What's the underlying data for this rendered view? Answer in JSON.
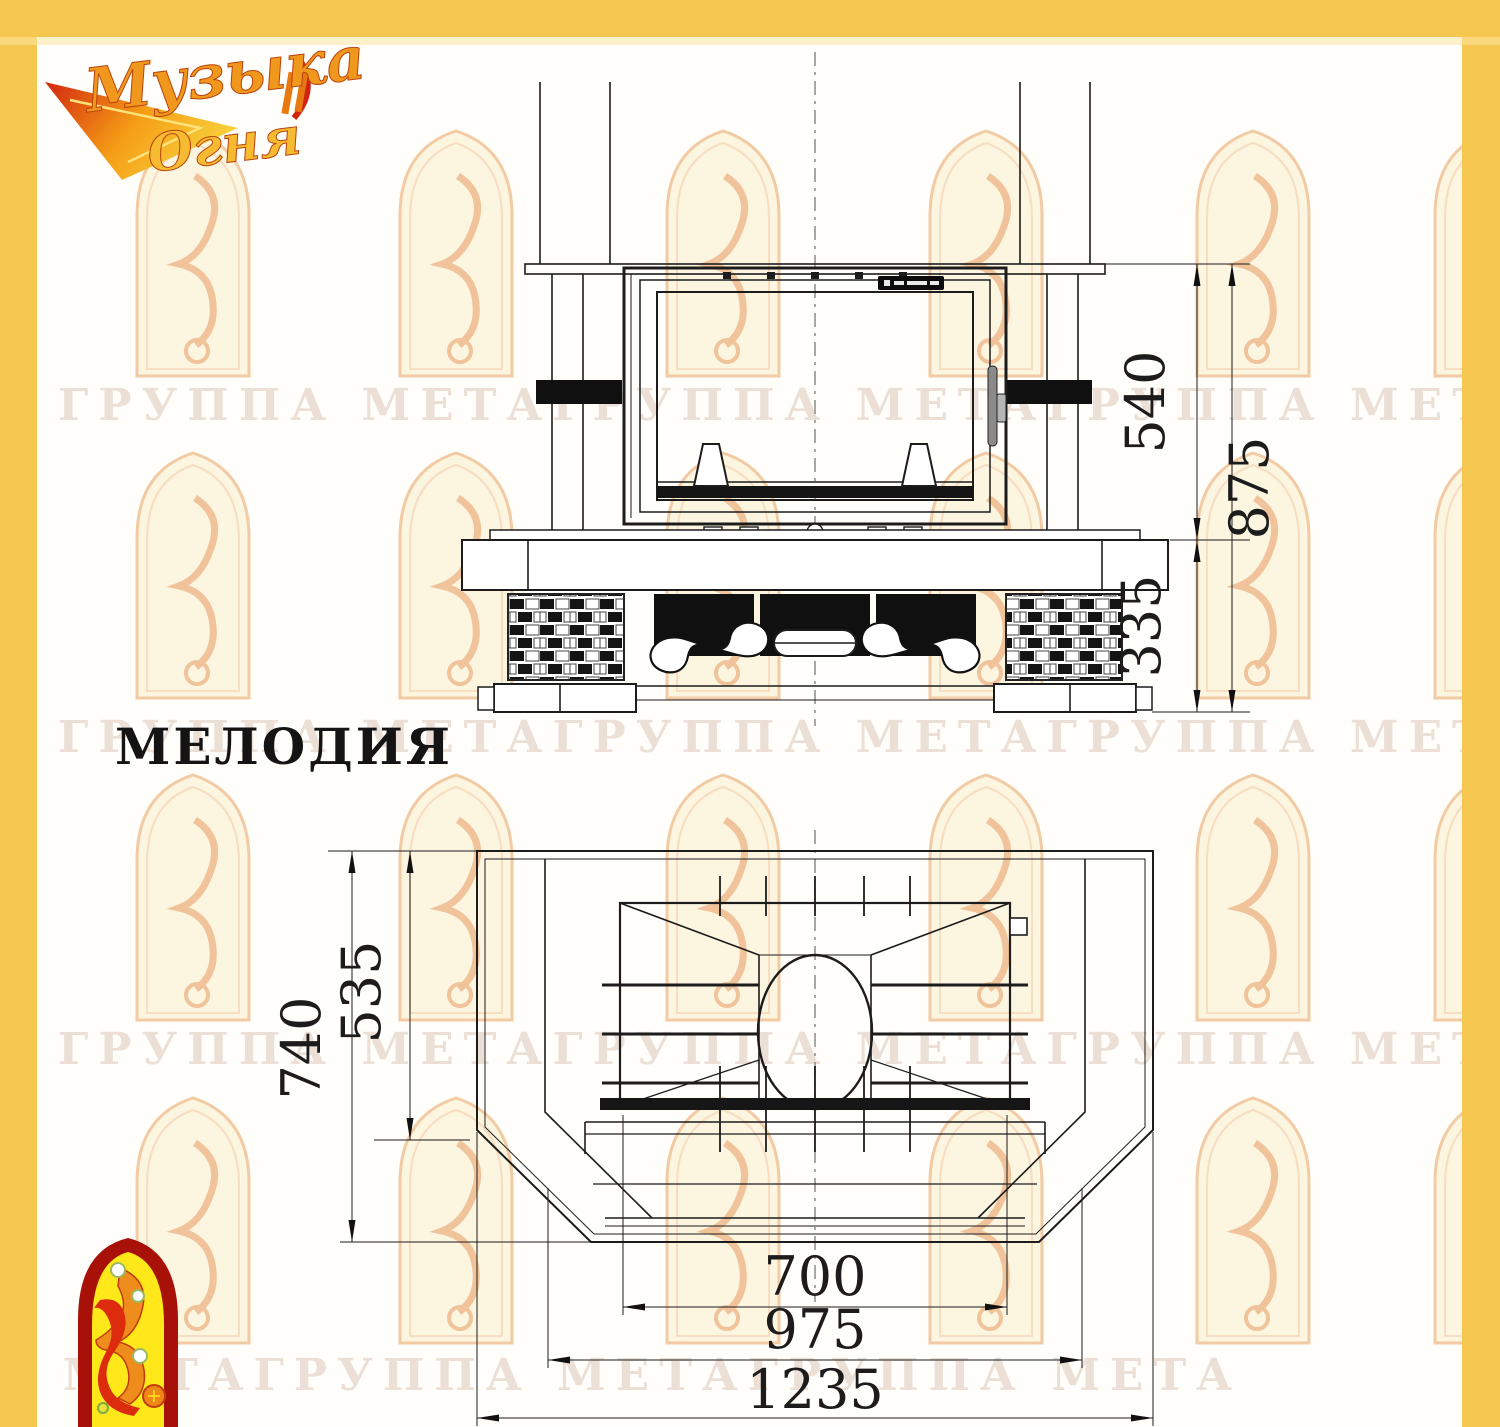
{
  "page": {
    "title": "МЕЛОДИЯ"
  },
  "brand": {
    "word1": "Музыка",
    "word2": "Огня"
  },
  "watermark": {
    "color": "#ecdfd6",
    "rows": [
      "ГРУППА МЕТАГРУППА МЕТАГРУППА МЕТА",
      "ГРУППА МЕТАГРУППА МЕТАГРУППА МЕТА",
      "ГРУППА МЕТАГРУППА МЕТАГРУППА МЕТ",
      "ПА МЕТАГРУППА МЕТАГРУППА МЕТА"
    ]
  },
  "dims": {
    "front_firebox_height": "540",
    "front_total_height": "875",
    "front_base_height": "335",
    "plan_depth": "740",
    "plan_inner_depth": "535",
    "plan_opening_width": "700",
    "plan_hearth_width": "975",
    "plan_overall_width": "1235"
  },
  "colors": {
    "border_yellow": "#f5c74f",
    "drawing_line": "#1c1c1c",
    "watermark_arch": "#f2cba4",
    "logo_red": "#d2250f",
    "logo_orange": "#f5a11c",
    "bottom_logo_arch": "#a81108",
    "bottom_logo_fill": "#ffe81a"
  }
}
